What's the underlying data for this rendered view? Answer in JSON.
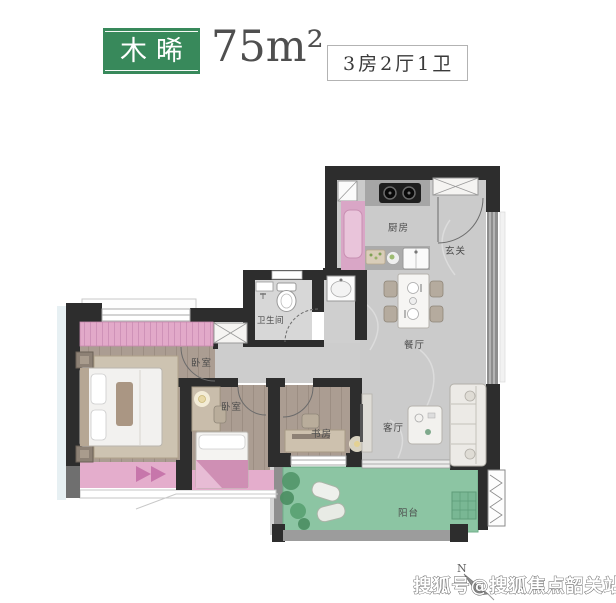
{
  "header": {
    "unit_name": "木晞",
    "area": "75m²",
    "layout_spec": "3房2厅1卫"
  },
  "rooms": {
    "kitchen": "厨房",
    "foyer": "玄关",
    "bathroom": "卫生间",
    "dining": "餐厅",
    "master_bedroom": "卧室",
    "second_bedroom": "卧室",
    "study": "书房",
    "living_room": "客厅",
    "balcony": "阳台"
  },
  "compass": {
    "north": "N"
  },
  "watermark": {
    "text": "搜狐号@搜狐焦点韶关站"
  },
  "colors": {
    "title_green": "#38895B",
    "wall_dark": "#2D2D2D",
    "bay_window_pink": "#E4ADCC",
    "wardrobe_pink": "#E2A9C9",
    "balcony_green": "#8CC5A3",
    "wood_floor": "#AB9D92",
    "marble_floor": "#CBCBCB"
  }
}
